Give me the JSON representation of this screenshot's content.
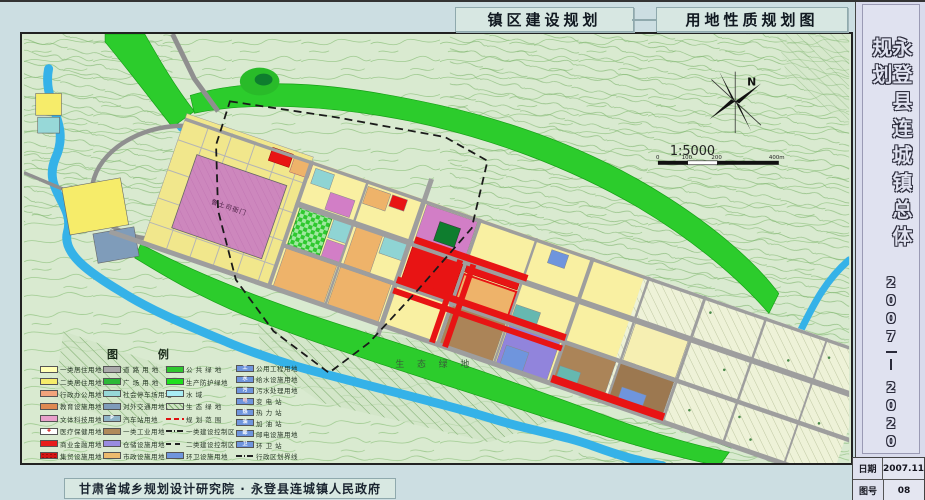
{
  "titles": {
    "left": "镇区建设规划",
    "right": "用地性质规划图"
  },
  "sidebar": {
    "title": "永登县连城镇总体规划",
    "years_top": "2007",
    "separator": "——",
    "years_bottom": "2020",
    "table": [
      {
        "label": "日期",
        "value": "2007.11"
      },
      {
        "label": "图号",
        "value": "08"
      }
    ]
  },
  "footer": {
    "credit": "甘肃省城乡规划设计研究院 · 永登县连城镇人民政府"
  },
  "map": {
    "north_label": "N",
    "scale_text": "1:5000",
    "scale_ticks": [
      "0",
      "100",
      "200",
      "400m"
    ],
    "labels": {
      "eco_green": "生 态 绿 地",
      "heritage": "鲁土司衙门"
    },
    "accent_colors": {
      "river": "#35b2e8",
      "protective_green": "#2ccc2c",
      "road": "#9e9e9e",
      "residential_1": "#f9f0a2",
      "residential_2": "#f6ec6a",
      "commercial_red": "#e81414",
      "heritage_pink": "#cd87bd",
      "warehouse_purple": "#9184dc",
      "industry_brown": "#ab8458"
    }
  },
  "legend": {
    "title": "图    例",
    "columns": [
      {
        "items": [
          {
            "label": "一类居住用地",
            "type": "fill",
            "color": "#ffffb4"
          },
          {
            "label": "二类居住用地",
            "type": "fill",
            "color": "#f6ec6a"
          },
          {
            "label": "行政办公用地",
            "type": "fill",
            "color": "#f2a47c"
          },
          {
            "label": "教育设施用地",
            "type": "fill",
            "color": "#df8a52"
          },
          {
            "label": "文体科技用地",
            "type": "fill",
            "color": "#e9a0cb"
          },
          {
            "label": "医疗保健用地",
            "type": "fill",
            "color": "#ffffff",
            "icon": "✚",
            "icon_color": "#d01010"
          },
          {
            "label": "商业金融用地",
            "type": "fill",
            "color": "#e81c1c"
          },
          {
            "label": "集贸设施用地",
            "type": "dots",
            "color": "#d41414"
          }
        ]
      },
      {
        "items": [
          {
            "label": "道 路 用 地",
            "type": "fill",
            "color": "#aaaaaa"
          },
          {
            "label": "广 场 用 地",
            "type": "fill",
            "color": "#2cb838"
          },
          {
            "label": "社会停车场用地",
            "type": "fill",
            "color": "#97d8d8"
          },
          {
            "label": "对外交通用地",
            "type": "fill",
            "color": "#7f9cba"
          },
          {
            "label": "汽车站用地",
            "type": "fill",
            "color": "#8fb4c8",
            "icon": "P",
            "icon_color": "#ffffff"
          },
          {
            "label": "一类工业用地",
            "type": "fill",
            "color": "#b08a5a"
          },
          {
            "label": "仓储设施用地",
            "type": "fill",
            "color": "#998ce0"
          },
          {
            "label": "市政设施用地",
            "type": "fill",
            "color": "#ecba6e"
          }
        ]
      },
      {
        "items": [
          {
            "label": "公 共 绿 地",
            "type": "fill",
            "color": "#2ec82e"
          },
          {
            "label": "生产防护绿地",
            "type": "fill",
            "color": "#1ee01e"
          },
          {
            "label": "水        域",
            "type": "fill",
            "color": "#a8ecf4"
          },
          {
            "label": "生 态 绿 地",
            "type": "hatch",
            "color": "#cfe3c4"
          },
          {
            "label": "规 划 范 围",
            "type": "line-red",
            "color": "#e01010"
          },
          {
            "label": "一类建设控制区",
            "type": "line-dashdot",
            "color": "#222222"
          },
          {
            "label": "二类建设控制区",
            "type": "line-dash",
            "color": "#222222"
          },
          {
            "label": "环卫设施用地",
            "type": "fill",
            "color": "#6f95dd"
          }
        ]
      },
      {
        "items": [
          {
            "label": "公用工程用地",
            "type": "fill",
            "color": "#6f95dd",
            "icon": "工",
            "icon_color": "#ffffff"
          },
          {
            "label": "给水设施用地",
            "type": "fill",
            "color": "#6f95dd",
            "icon": "水",
            "icon_color": "#ffffff"
          },
          {
            "label": "污水处理用地",
            "type": "fill",
            "color": "#6f95dd",
            "icon": "污",
            "icon_color": "#ffffff"
          },
          {
            "label": "变  电  站",
            "type": "fill",
            "color": "#6f95dd",
            "icon": "电",
            "icon_color": "#ffd0d0"
          },
          {
            "label": "热  力  站",
            "type": "fill",
            "color": "#6f95dd",
            "icon": "热",
            "icon_color": "#ffffff"
          },
          {
            "label": "加  油  站",
            "type": "fill",
            "color": "#6f95dd",
            "icon": "油",
            "icon_color": "#ffffff"
          },
          {
            "label": "邮电设施用地",
            "type": "fill",
            "color": "#6f95dd",
            "icon": "邮",
            "icon_color": "#ffffff"
          },
          {
            "label": "环  卫  站",
            "type": "fill",
            "color": "#6f95dd",
            "icon": "卫",
            "icon_color": "#ffffff"
          },
          {
            "label": "行政区划界线",
            "type": "line-dashdot",
            "color": "#222222"
          }
        ]
      }
    ]
  }
}
